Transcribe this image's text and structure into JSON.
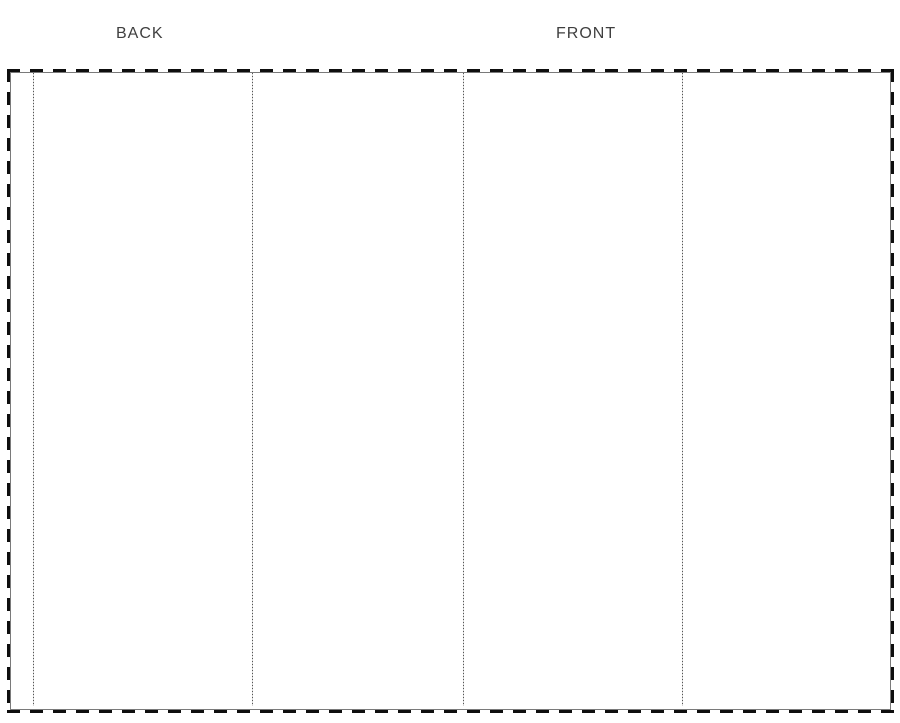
{
  "page": {
    "background": "#ffffff"
  },
  "labels": {
    "back": "BACK",
    "front": "FRONT"
  },
  "template": {
    "border_color": "#0e0e0e",
    "cut_line_color": "#7a7a7a",
    "fold_line_color": "#555555",
    "label_color": "#3f3f3f",
    "fold_lines_x": [
      33,
      252,
      463,
      682
    ],
    "panel_bounds_x": [
      8,
      33,
      252,
      463,
      682,
      892
    ],
    "panel_names": [
      "left-flap",
      "back",
      "inside-left",
      "front",
      "inside-right"
    ]
  }
}
